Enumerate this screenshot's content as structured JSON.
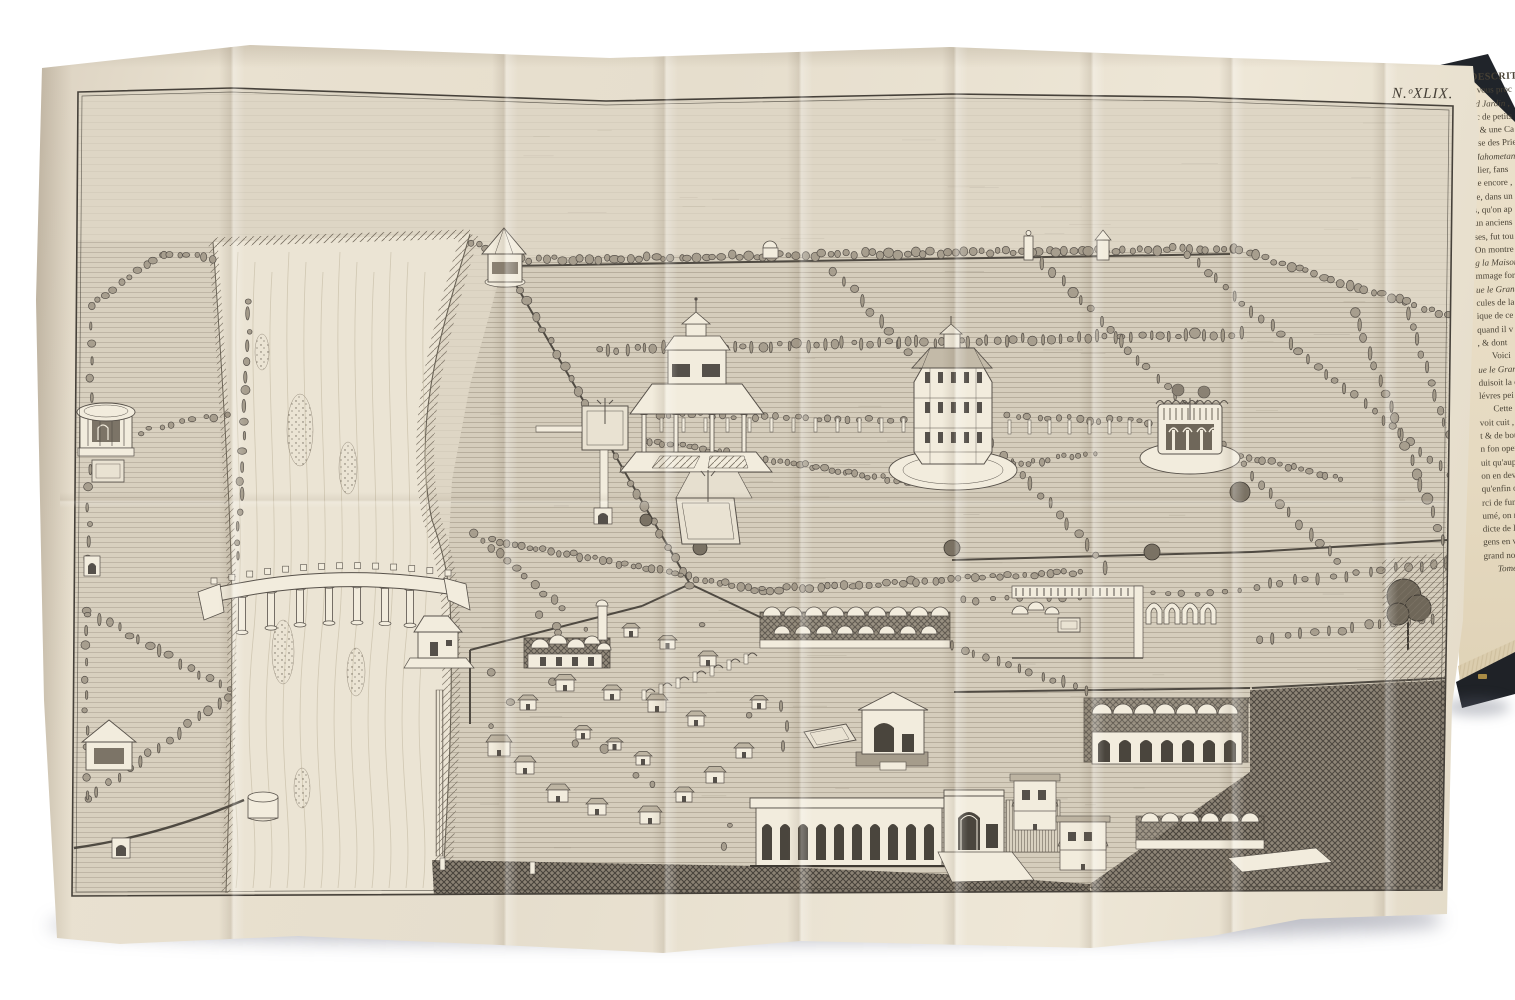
{
  "photo": {
    "background_color": "#ffffff"
  },
  "plate": {
    "label": "N.ᵒXLIX.",
    "paper_color": "#e8e0cf",
    "frame_color": "#46413a"
  },
  "engraving": {
    "ink_color": "#57514a",
    "paper_white": "#f2ecdd",
    "subject": "bird's-eye view of walled gardens with river, bridge, pavilions, tree avenues and domed buildings",
    "features": [
      "river",
      "bridge",
      "riverside-house",
      "river-gazebo",
      "left-kiosk",
      "left-gazebo",
      "columned-pavilion",
      "octagonal-palace",
      "round-colonnade",
      "tree-avenues",
      "village-houses",
      "domed-bazaar",
      "court-with-domes",
      "ruined-arches",
      "caravanserai",
      "dome-row",
      "arcade-loggia",
      "domed-shrine",
      "gateway",
      "pool",
      "dark-foreground-fields"
    ]
  },
  "book_page": {
    "paper_color": "#e7dcc6",
    "board_color": "#20242a",
    "lines": [
      {
        "t": "DESCRITPI",
        "h": true
      },
      {
        "t": "a vous proc"
      },
      {
        "t": "nd Jardin ,",
        "i": true
      },
      {
        "t": "uc de petits"
      },
      {
        "t": "s, & une Ca"
      },
      {
        "t": "isse des Prie"
      },
      {
        "t": "Mahometanes",
        "i": true
      },
      {
        "t": "ulier, fans"
      },
      {
        "t": "de encore ,"
      },
      {
        "t": "re, dans un"
      },
      {
        "t": "s, qu'on ap"
      },
      {
        "t": "un anciens"
      },
      {
        "t": "ses, fut tou"
      },
      {
        "t": "On montre po"
      },
      {
        "t": "g la Maison",
        "i": true
      },
      {
        "t": "mmage fort"
      },
      {
        "t": "ue le Grand",
        "i": true
      },
      {
        "t": "cules de la"
      },
      {
        "t": "ique de ce"
      },
      {
        "t": "quand il v"
      },
      {
        "t": ", & dont"
      },
      {
        "t": "Voici",
        "p": true
      },
      {
        "t": "ue le Grand",
        "i": true
      },
      {
        "t": "duisoit la c"
      },
      {
        "t": "lévres pei"
      },
      {
        "t": "Cette d",
        "p": true
      },
      {
        "t": "voit cuit ,"
      },
      {
        "t": "t & de bou"
      },
      {
        "t": "n fon oper"
      },
      {
        "t": "uit qu'aup"
      },
      {
        "t": "on en dev"
      },
      {
        "t": "qu'enfin on"
      },
      {
        "t": "rci de fune"
      },
      {
        "t": "umé, on n"
      },
      {
        "t": "dicte de le"
      },
      {
        "t": "gens en v"
      },
      {
        "t": "grand nom"
      },
      {
        "t": "Tome V",
        "i": true,
        "p": true
      }
    ]
  }
}
